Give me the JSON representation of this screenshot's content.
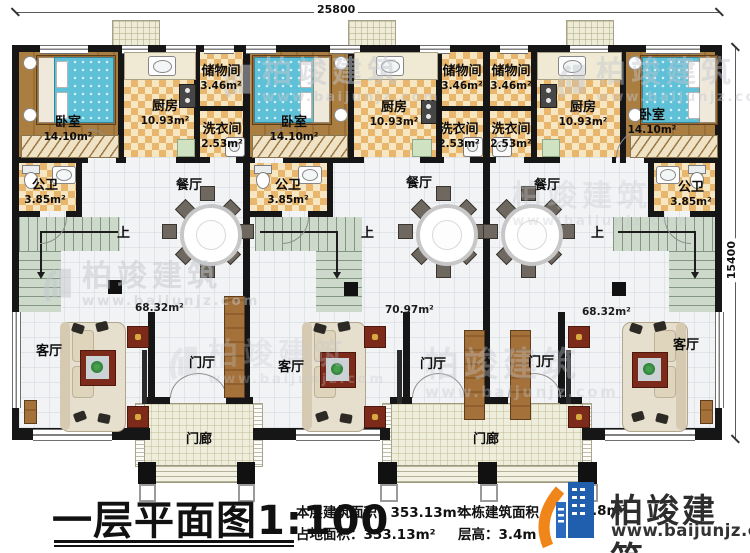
{
  "dims": {
    "width": "25800",
    "height": "15400"
  },
  "labels": {
    "bedroom": {
      "name": "卧室",
      "area": "14.10m²"
    },
    "kitchen": {
      "name": "厨房",
      "area": "10.93m²"
    },
    "storage": {
      "name": "储物间",
      "area": "3.46m²"
    },
    "laundry": {
      "name": "洗衣间",
      "area": "2.53m²"
    },
    "bath": {
      "name": "公卫",
      "area": "3.85m²"
    },
    "dining": "餐厅",
    "living": "客厅",
    "hall": "门厅",
    "porch": "门廊",
    "up": "上",
    "unit_area_left": "68.32m²",
    "unit_area_middle": "70.97m²",
    "unit_area_right": "68.32m²"
  },
  "footer": {
    "title": "一层平面图1:100",
    "floor_area_label": "本层建筑面积：",
    "floor_area_value": "353.13m²",
    "footprint_label": "占地面积：",
    "footprint_value": "353.13m²",
    "building_area_label": "本栋建筑面积",
    "building_area_fragment": ".8m²",
    "floor_height_label": "层高：",
    "floor_height_value": "3.4m"
  },
  "brand": {
    "name": "柏竣建筑",
    "url": "www.baijunjz.com"
  }
}
